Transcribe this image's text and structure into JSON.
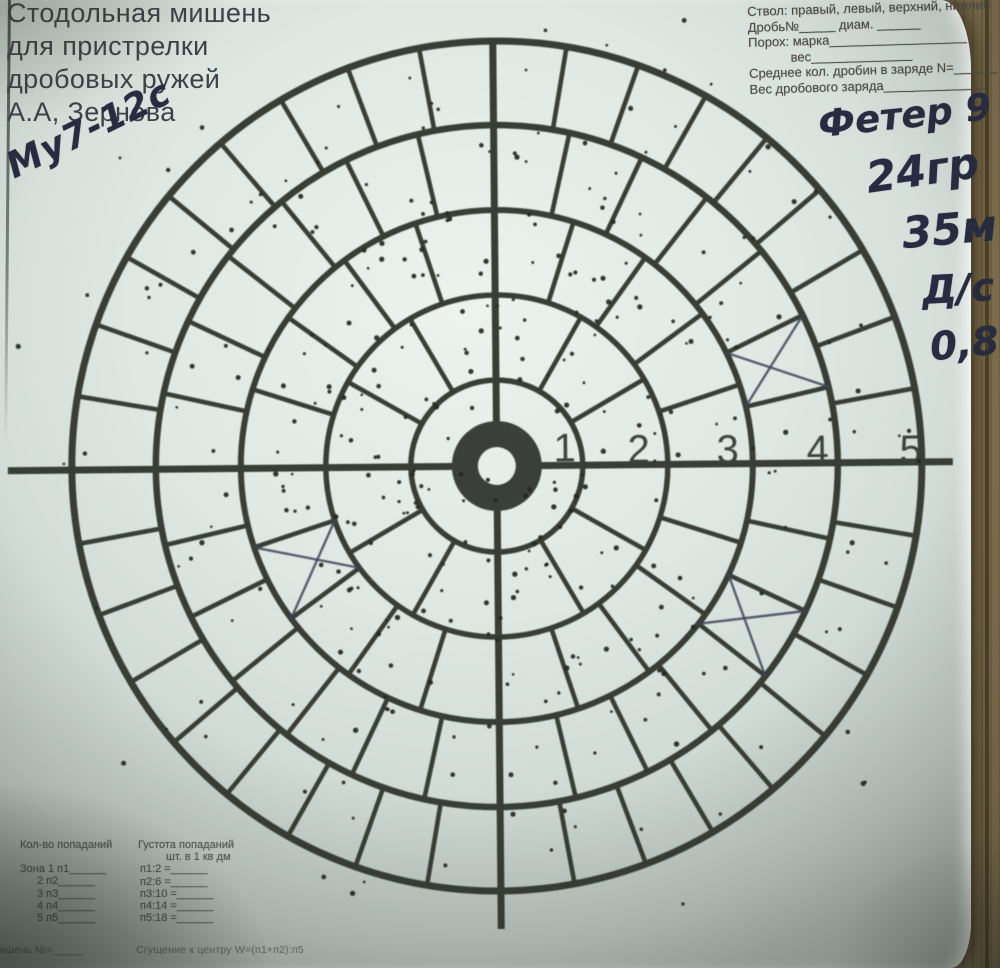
{
  "title": {
    "lines": [
      "Стодольная мишень",
      "для пристрелки",
      "дробовых ружей",
      "А.А, Зернова"
    ]
  },
  "form": {
    "lines": [
      "Ствол: правый, левый, верхний, нижний",
      "Дробь№_____  диам. ______",
      "Порох: марка___________________",
      "вес______________",
      "Среднее кол. дробин в заряде N=______",
      "Вес дробового заряда______________"
    ]
  },
  "handwriting": {
    "gun_note": "Му7-12с",
    "shot_brand": "Фетер 9",
    "load_weight": "24гр",
    "distance": "35м",
    "choke": "Д/с",
    "choke_value": "0,8"
  },
  "zone_numbers": [
    "1",
    "2",
    "3",
    "4",
    "5"
  ],
  "footer": {
    "hits_header": "Кол-во попаданий",
    "density_header": "Густота попаданий",
    "density_sub": "шт. в 1 кв дм",
    "hits_rows": [
      "Зона 1 п1______",
      "2 п2______",
      "3 п3______",
      "4 п4______",
      "5 п5______"
    ],
    "density_rows": [
      "п1:2 =______",
      "п2:6 =______",
      "п3:10 =______",
      "п4:14 =______",
      "п5:18 =______"
    ],
    "bottom_left": "мишень №=_____",
    "bottom_formula": "Сгущение к центру W=(п1+п2):п5"
  },
  "target": {
    "cx": 497,
    "cy": 466,
    "zone_radii": [
      86,
      171,
      256,
      341,
      425
    ],
    "ring_widths": [
      5.5,
      5.5,
      6,
      6.5,
      7
    ],
    "segments_per_zone": [
      4,
      12,
      20,
      28,
      36
    ],
    "radial_width": 4.6,
    "cross": {
      "x_left": 8,
      "x_right": 953,
      "y_top": 41,
      "y_bottom": 929,
      "width": 7
    },
    "bull": {
      "outer_r": 45,
      "inner_r": 19,
      "color": "#3b3f39",
      "hole_color": "#e7ede8"
    },
    "line_color": "#383e36",
    "number_color": "#3b413b",
    "number_font_size": 40,
    "number_positions": [
      [
        565,
        462
      ],
      [
        639,
        464
      ],
      [
        728,
        465
      ],
      [
        818,
        466
      ],
      [
        911,
        467
      ]
    ],
    "pen_marks": {
      "color": "#3c4359",
      "width": 2.4,
      "crossed_sections": [
        {
          "r0": 256,
          "r1": 341,
          "a0": 12.9,
          "a1": 25.7
        },
        {
          "r0": 171,
          "r1": 256,
          "a0": 198,
          "a1": 216
        },
        {
          "r0": 256,
          "r1": 341,
          "a0": 321.4,
          "a1": 334.3
        }
      ]
    },
    "pellets": {
      "seed": 13,
      "count": 335,
      "mean": [
        491,
        441
      ],
      "sigma": [
        192,
        200
      ],
      "max_r_from_center": 495,
      "dot_color": "#23271f"
    }
  }
}
